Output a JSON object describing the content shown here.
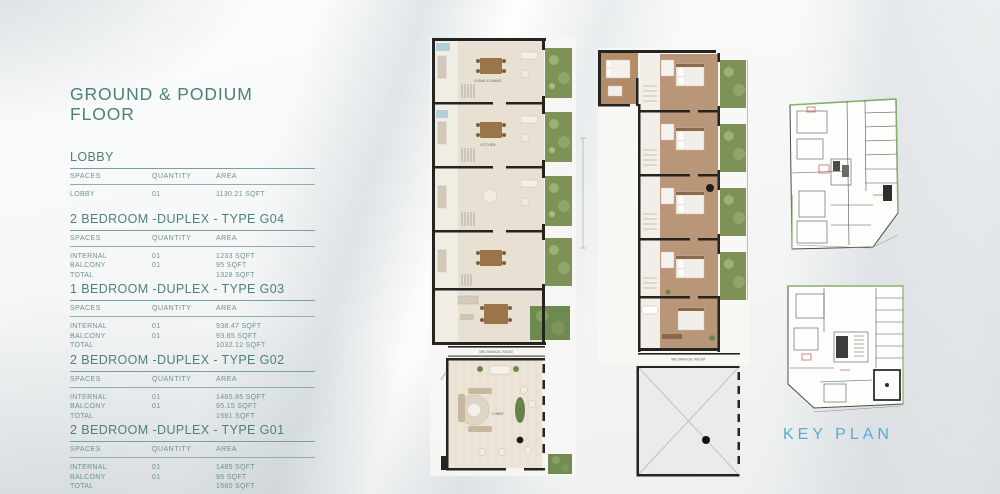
{
  "page": {
    "title": "GROUND & PODIUM FLOOR",
    "key_plan_label": "KEY PLAN"
  },
  "tables": [
    {
      "heading": "LOBBY",
      "columns": [
        "SPACES",
        "QUANTITY",
        "AREA"
      ],
      "rows": [
        [
          "LOBBY",
          "01",
          "1130.21 SQFT"
        ]
      ]
    },
    {
      "heading": "2 BEDROOM -DUPLEX - TYPE G04",
      "columns": [
        "SPACES",
        "QUANTITY",
        "AREA"
      ],
      "rows": [
        [
          "INTERNAL",
          "01",
          "1233 SQFT"
        ],
        [
          "BALCONY",
          "01",
          "95 SQFT"
        ],
        [
          "TOTAL",
          "",
          "1328 SQFT"
        ]
      ]
    },
    {
      "heading": "1 BEDROOM -DUPLEX - TYPE G03",
      "columns": [
        "SPACES",
        "QUANTITY",
        "AREA"
      ],
      "rows": [
        [
          "INTERNAL",
          "01",
          "938.47 SQFT"
        ],
        [
          "BALCONY",
          "01",
          "93.65 SQFT"
        ],
        [
          "TOTAL",
          "",
          "1032.12 SQFT"
        ]
      ]
    },
    {
      "heading": "2 BEDROOM -DUPLEX - TYPE G02",
      "columns": [
        "SPACES",
        "QUANTITY",
        "AREA"
      ],
      "rows": [
        [
          "INTERNAL",
          "01",
          "1485.85 SQFT"
        ],
        [
          "BALCONY",
          "01",
          "95.15 SQFT"
        ],
        [
          "TOTAL",
          "",
          "1581 SQFT"
        ]
      ]
    },
    {
      "heading": "2 BEDROOM -DUPLEX - TYPE G01",
      "columns": [
        "SPACES",
        "QUANTITY",
        "AREA"
      ],
      "rows": [
        [
          "INTERNAL",
          "01",
          "1485 SQFT"
        ],
        [
          "BALCONY",
          "01",
          "95 SQFT"
        ],
        [
          "TOTAL",
          "",
          "1580 SQFT"
        ]
      ]
    }
  ],
  "plans": {
    "left": {
      "labels": {
        "living_dining": "LIVING & DINING",
        "kitchen": "KITCHEN",
        "lobby": "LOBBY",
        "mechanical_room": "MECHANICAL ROOM"
      }
    },
    "right": {
      "labels": {
        "mechanical_room": "MECHANICAL ROOM"
      }
    }
  },
  "colors": {
    "heading_teal": "#4e807c",
    "table_text_teal": "#6d928e",
    "keyplan_blue": "#55abd6",
    "balcony_green": "#7e9257",
    "wall_dark": "#242421",
    "floor_beige": "#e7e0d3",
    "floor_wood_brown": "#b99678",
    "keyplan_green_edge": "#86b06c",
    "keyplan_red_accent": "#c4554d"
  }
}
